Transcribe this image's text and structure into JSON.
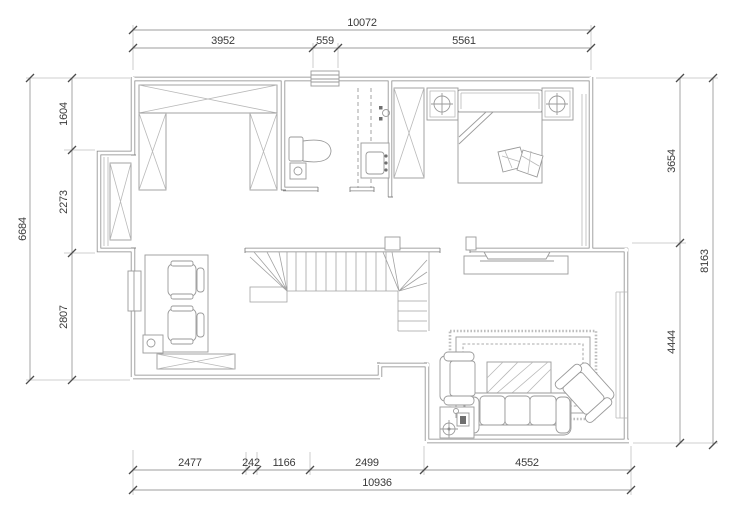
{
  "drawing": {
    "type": "floor-plan",
    "units": "mm",
    "dims": {
      "top": {
        "total": "10072",
        "seg": [
          "3952",
          "559",
          "5561"
        ]
      },
      "left": {
        "total": "6684",
        "seg": [
          "1604",
          "2273",
          "2807"
        ]
      },
      "right": {
        "total": "8163",
        "seg": [
          "3654",
          "4444"
        ]
      },
      "bottom": {
        "total": "10936",
        "seg": [
          "2477",
          "242",
          "1166",
          "2499",
          "4552"
        ]
      }
    },
    "colors": {
      "background": "#ffffff",
      "wall_line": "#848484",
      "furniture_line": "#9a9a9a",
      "dimension_line": "#9c9c9c",
      "dimension_text": "#3a3a3a"
    }
  }
}
